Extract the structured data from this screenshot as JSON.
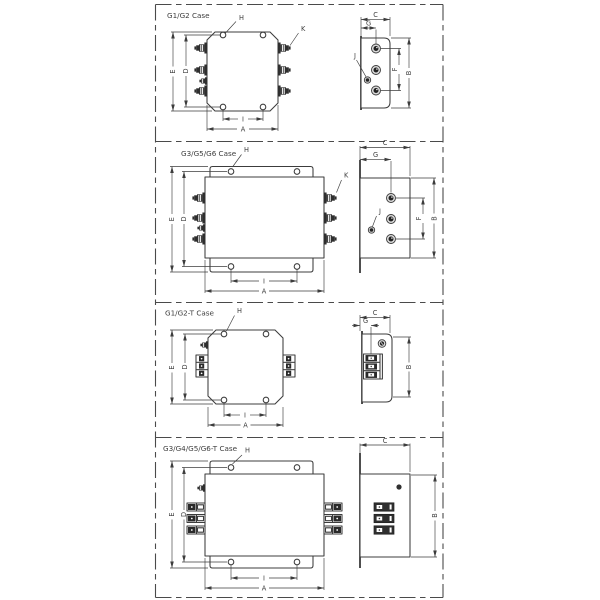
{
  "sheet": {
    "background": "#ffffff",
    "border_style": "dashed",
    "line_color": "#3c3c3c"
  },
  "dim_labels": {
    "A": "A",
    "B": "B",
    "C": "C",
    "D": "D",
    "E": "E",
    "F": "F",
    "G": "G",
    "H": "H",
    "I": "I",
    "J": "J",
    "K": "K"
  },
  "panels": [
    {
      "title": "G1/G2 Case",
      "views": [
        "front",
        "side"
      ],
      "dims_shown": [
        "A",
        "B",
        "C",
        "D",
        "E",
        "F",
        "G",
        "H",
        "I",
        "J",
        "K"
      ]
    },
    {
      "title": "G3/G5/G6 Case",
      "views": [
        "front",
        "side"
      ],
      "dims_shown": [
        "A",
        "B",
        "C",
        "D",
        "E",
        "F",
        "G",
        "H",
        "I",
        "J",
        "K"
      ]
    },
    {
      "title": "G1/G2-T Case",
      "views": [
        "front",
        "side"
      ],
      "dims_shown": [
        "A",
        "B",
        "C",
        "D",
        "E",
        "G",
        "H",
        "I"
      ]
    },
    {
      "title": "G3/G4/G5/G6-T Case",
      "views": [
        "front",
        "side"
      ],
      "dims_shown": [
        "A",
        "B",
        "C",
        "D",
        "E",
        "H",
        "I"
      ]
    }
  ],
  "symbols": {
    "terminal_bolt": "stud-terminal-icon",
    "terminal_circle": "stud-end-view-icon",
    "ground_stud": "ground-stud-icon",
    "terminal_block": "terminal-block-icon",
    "mounting_hole": "mounting-hole-icon"
  }
}
